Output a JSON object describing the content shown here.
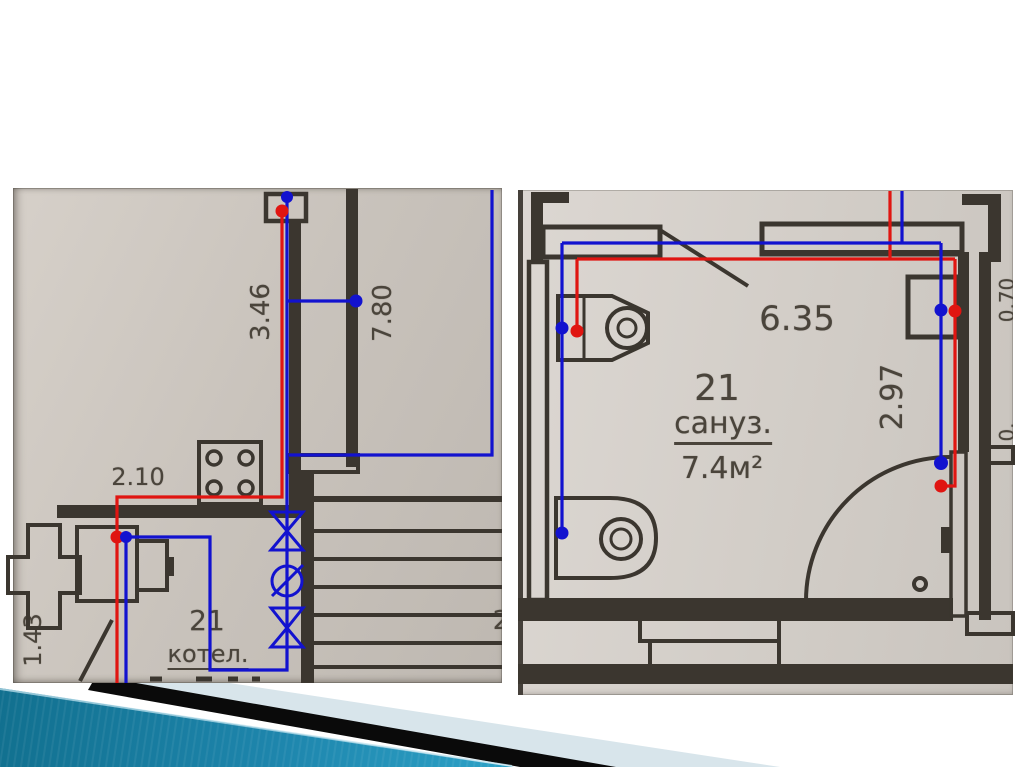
{
  "slide_type": "presentation-slide-with-floor-plans",
  "left_plan": {
    "caption": "boiler room plan crop",
    "dim_riser": "3.46",
    "dim_stairwell": "7.80",
    "dim_run": "2.10",
    "dim_side": "1.43",
    "room_number": "21",
    "room_name": "котел.",
    "stair_number": "2"
  },
  "right_plan": {
    "caption": "bathroom plan crop",
    "dim_width": "6.35",
    "dim_depth": "2.97",
    "dim_edge_top": "0.70",
    "dim_edge_bottom": "0.",
    "room_number": "21",
    "room_name": "сануз.",
    "room_area": "7.4м²"
  },
  "colors": {
    "pipe_blue": "#1212cf",
    "pipe_red": "#e01511",
    "wall": "#3b362f",
    "paper_left": "#c9c3bc",
    "paper_right": "#d2cdc7",
    "footer_teal_dark": "#11708f",
    "footer_teal_light": "#2ea3c8",
    "footer_black": "#0a0a0a",
    "footer_pale": "#d8e5eb",
    "background": "#ffffff"
  }
}
